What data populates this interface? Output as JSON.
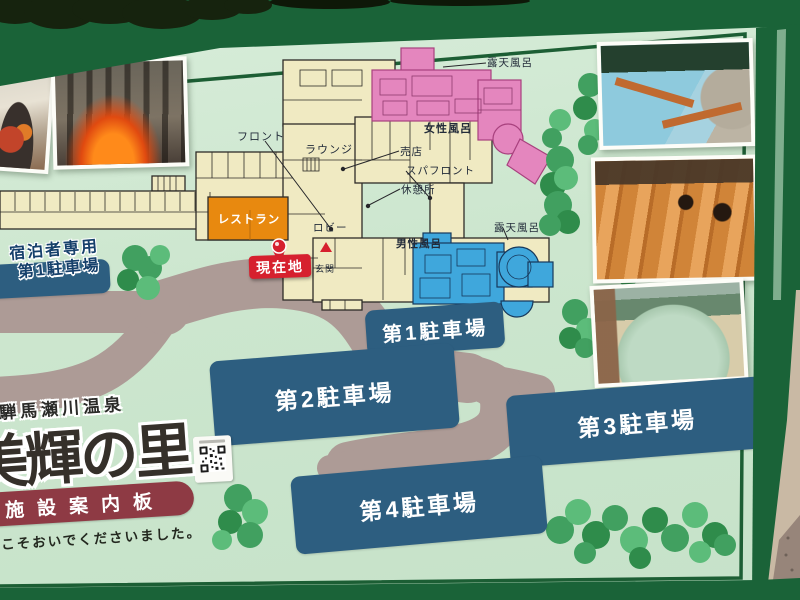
{
  "board": {
    "onsen_name": "飛騨馬瀬川温泉",
    "facility_name": "美輝の里",
    "banner_label": "施設案内板",
    "welcome_message": "ようこそおいでくださいました。"
  },
  "facility_map": {
    "labels": {
      "front_desk": "フロント",
      "lounge": "ラウンジ",
      "shop": "売店",
      "spa_front": "スパフロント",
      "rest_area": "休憩所",
      "lobby": "ロビー",
      "entrance": "玄関",
      "restaurant": "レストラン",
      "womens_bath": "女性風呂",
      "womens_open_air_bath": "露天風呂",
      "mens_bath": "男性風呂",
      "mens_open_air_bath": "露天風呂",
      "current_location": "現在地"
    },
    "parking_lots": {
      "guest_only_line1": "宿泊者専用",
      "guest_only_line2": "第1駐車場",
      "lot1": "第1駐車場",
      "lot2": "第2駐車場",
      "lot3": "第3駐車場",
      "lot4": "第4駐車場"
    },
    "icons": {
      "current_location_pin": "map-pin",
      "entrance_marker": "triangle-up",
      "qr_sticker": "qr-code"
    }
  },
  "colors": {
    "board_background": "#cce6ce",
    "frame_green": "#1a6338",
    "road": "#ad9b96",
    "building_yellow": "#f0eac2",
    "restaurant_orange": "#e8890f",
    "womens_bath_pink": "#e486be",
    "mens_bath_blue": "#3fa7dc",
    "parking_blue": "#2d5e80",
    "badge_red": "#d6202e",
    "banner_red": "#8e3a44"
  }
}
